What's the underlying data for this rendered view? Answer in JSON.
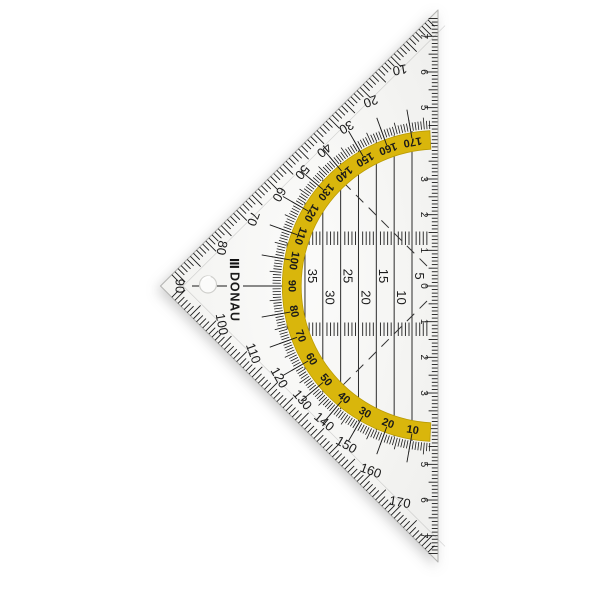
{
  "photo": {
    "background": "#ffffff"
  },
  "triangle": {
    "brand": {
      "name": "DONAU",
      "logo_icon": "three-bars-icon"
    },
    "colors": {
      "body": "#f5f5f3",
      "body_light": "#fbfbfa",
      "ink": "#1a1a1a",
      "yellow": "#d9b60c",
      "yellow_edge": "#bb9c04",
      "edge_line": "#b5b5b3"
    },
    "protractor": {
      "outer_degree_labels": [
        10,
        20,
        30,
        40,
        50,
        60,
        70,
        80,
        90,
        100,
        110,
        120,
        130,
        140,
        150,
        160,
        170
      ],
      "inner_degree_labels": [
        170,
        160,
        150,
        140,
        130,
        120,
        110,
        100,
        90,
        80,
        70,
        60,
        50,
        40,
        30,
        20,
        10
      ],
      "degree_step": 10
    },
    "hypotenuse_ruler": {
      "zero_label": "0",
      "cm_labels_up": [
        1,
        2,
        3,
        4,
        5,
        6,
        7
      ],
      "cm_labels_down": [
        1,
        2,
        3,
        4,
        5,
        6,
        7
      ]
    },
    "parallel_line_labels_mm": [
      5,
      10,
      15,
      20,
      25,
      30,
      35
    ]
  }
}
